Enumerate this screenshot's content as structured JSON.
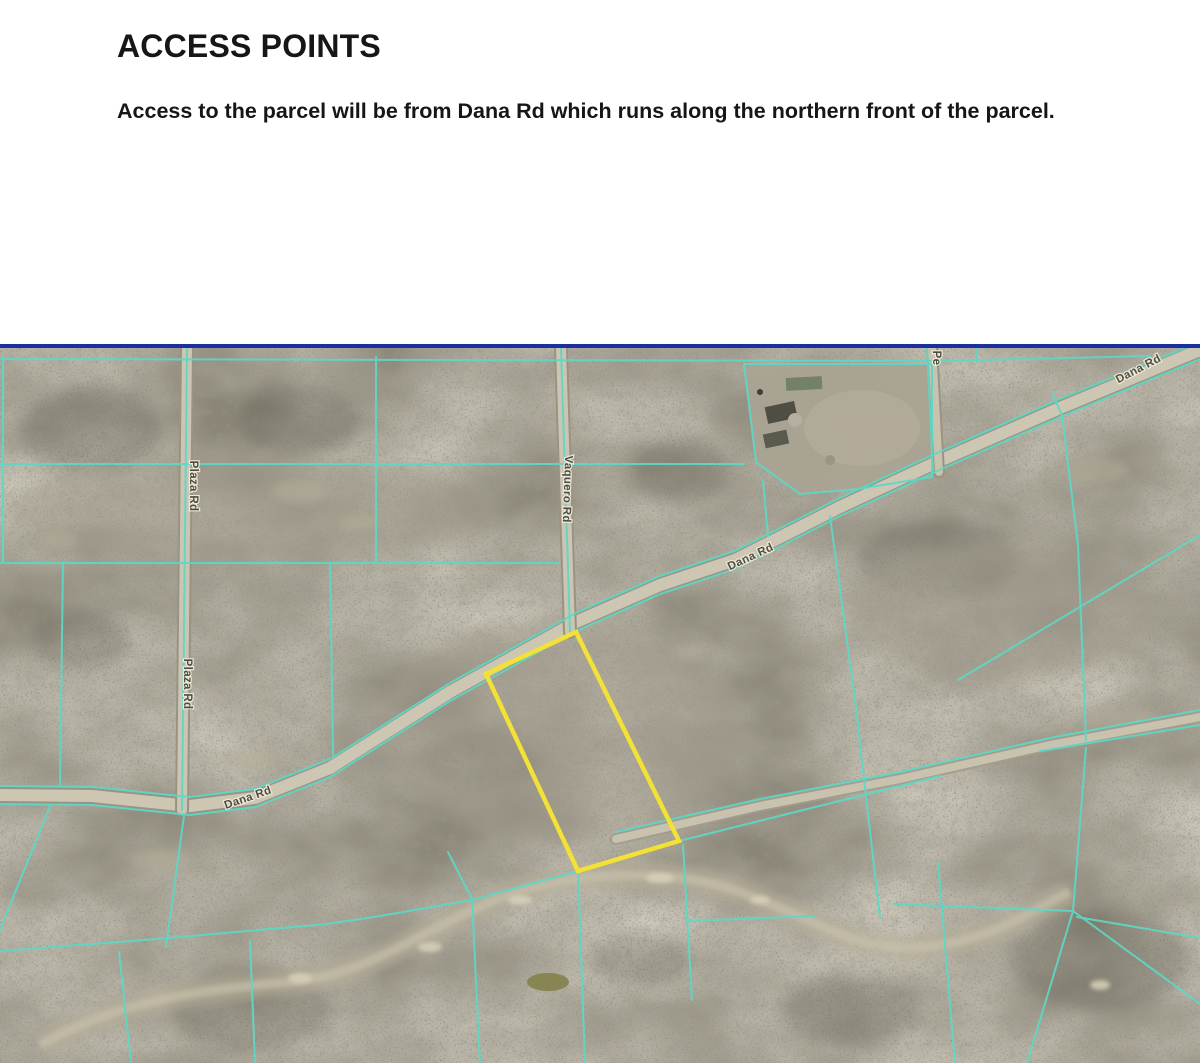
{
  "document": {
    "heading": "ACCESS POINTS",
    "paragraph": "Access to the parcel will be from Dana Rd which runs along the northern front of the parcel."
  },
  "map": {
    "labels": {
      "dana_top": "Dana Rd",
      "dana_mid": "Dana Rd",
      "dana_bottom": "Dana Rd",
      "plaza_upper": "Plaza Rd",
      "plaza_lower": "Plaza Rd",
      "vaquero": "Vaquero Rd",
      "partial": "Pe"
    },
    "colors": {
      "parcel_line": "#5ed8c6",
      "highlight_outline": "#f3e135",
      "top_border": "#1c2f9e",
      "terrain_base": "#8a8577",
      "road_surface": "#cdc6b3"
    }
  }
}
